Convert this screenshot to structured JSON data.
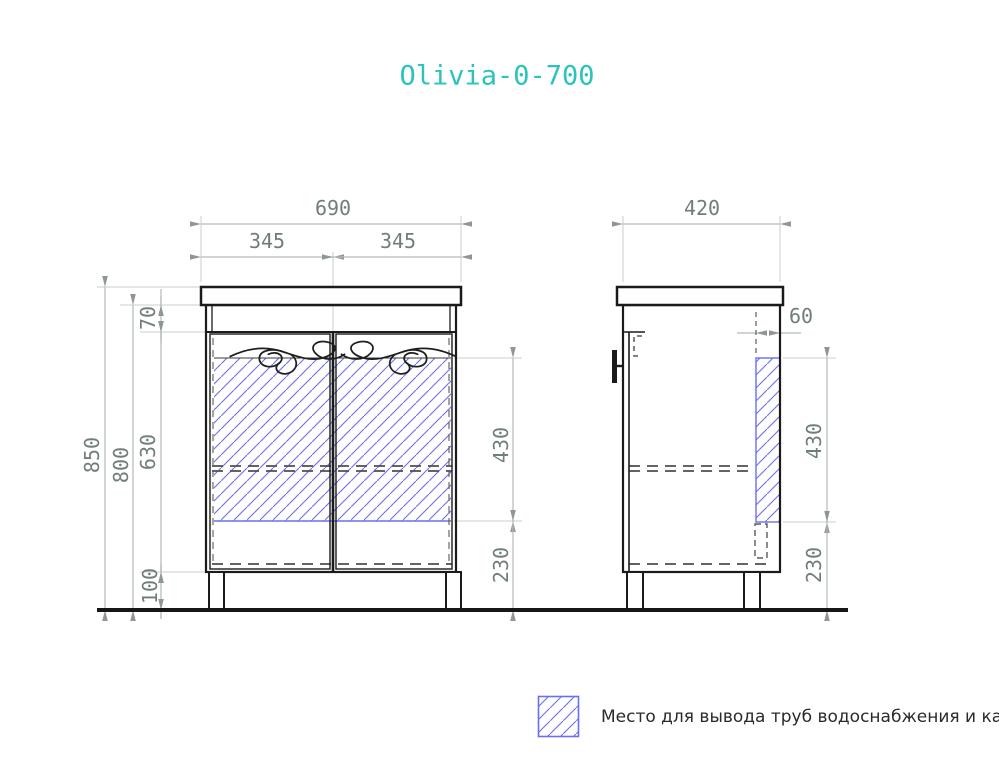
{
  "title": "Olivia-0-700",
  "dims": {
    "front_width": "690",
    "front_half_left": "345",
    "front_half_right": "345",
    "side_width": "420",
    "total_height": "850",
    "body_height": "800",
    "band_height": "70",
    "door_height": "630",
    "leg_height": "100",
    "front_pipe_height": "430",
    "front_pipe_bottom": "230",
    "side_pipe_width": "60",
    "side_pipe_height": "430",
    "side_pipe_bottom": "230"
  },
  "legend": {
    "label": "Место для вывода труб водоснабжения и канализации"
  },
  "colors": {
    "title": "#2bc4bc",
    "hatch": "#6a6ef0",
    "dim_text": "#6f7e78",
    "outline": "#1b1b1b"
  }
}
